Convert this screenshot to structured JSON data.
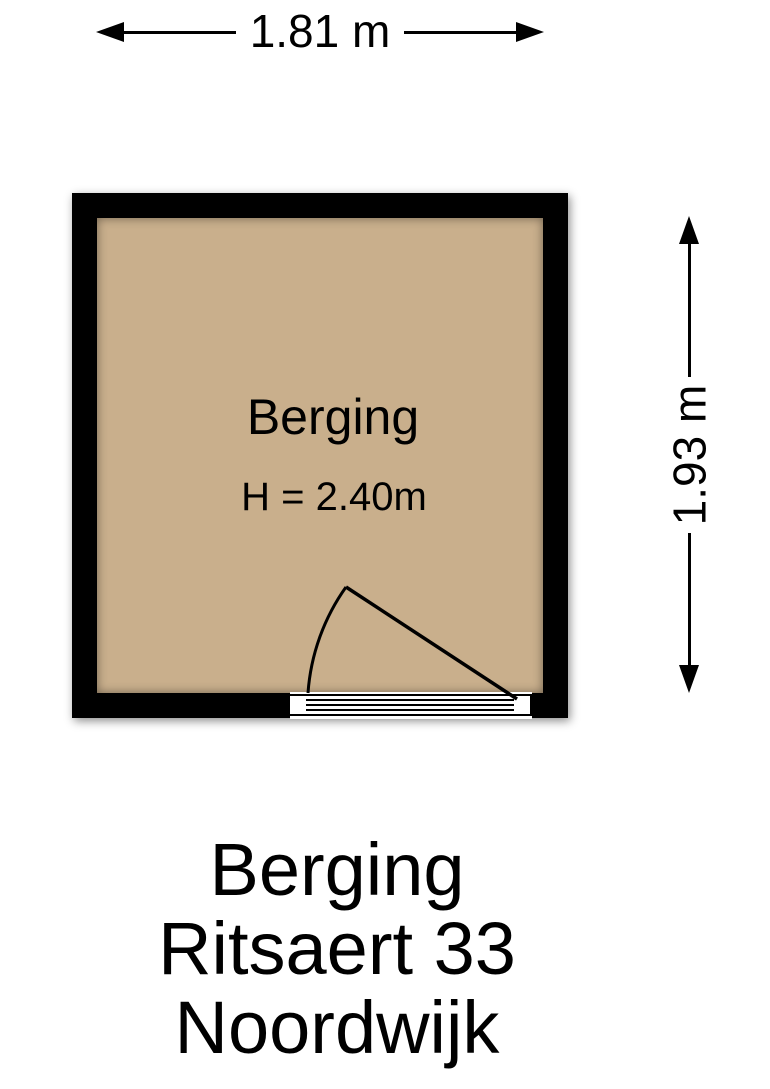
{
  "plan": {
    "room_label": "Berging",
    "room_height_label": "H = 2.40m",
    "dim_width_label": "1.81 m",
    "dim_height_label": "1.93 m"
  },
  "caption": {
    "line1": "Berging",
    "line2": "Ritsaert 33",
    "line3": "Noordwijk"
  },
  "colors": {
    "wall": "#000000",
    "floor": "#c9af8c",
    "background": "#ffffff",
    "line": "#000000"
  }
}
